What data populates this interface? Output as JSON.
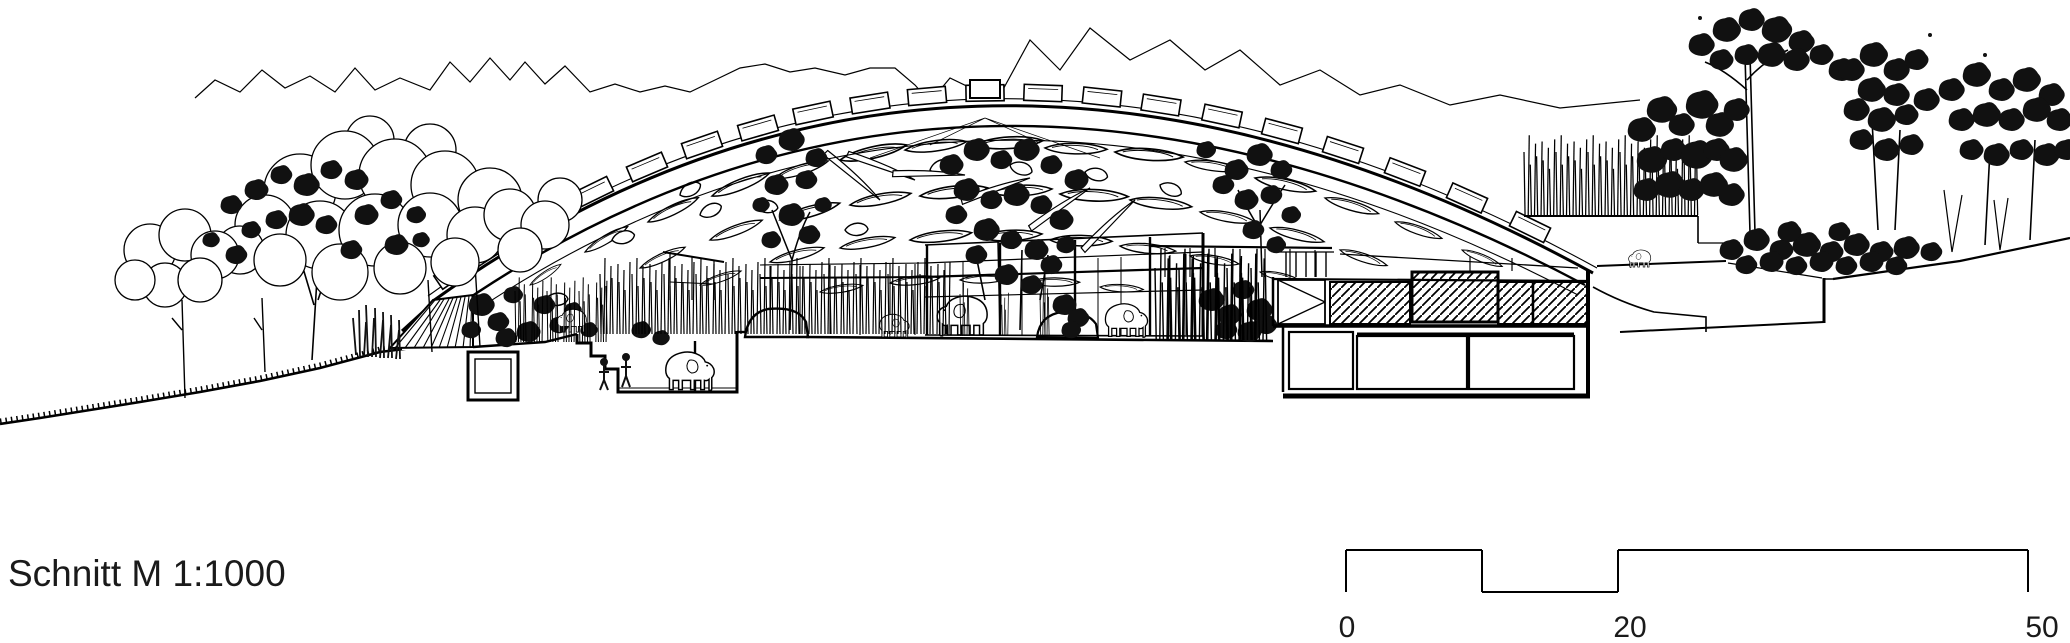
{
  "title": "Schnitt M 1:1000",
  "scale_bar": {
    "labels": [
      "0",
      "20",
      "50"
    ],
    "unit_hint": "meters"
  },
  "colors": {
    "ink": "#000000",
    "paper": "#ffffff"
  }
}
